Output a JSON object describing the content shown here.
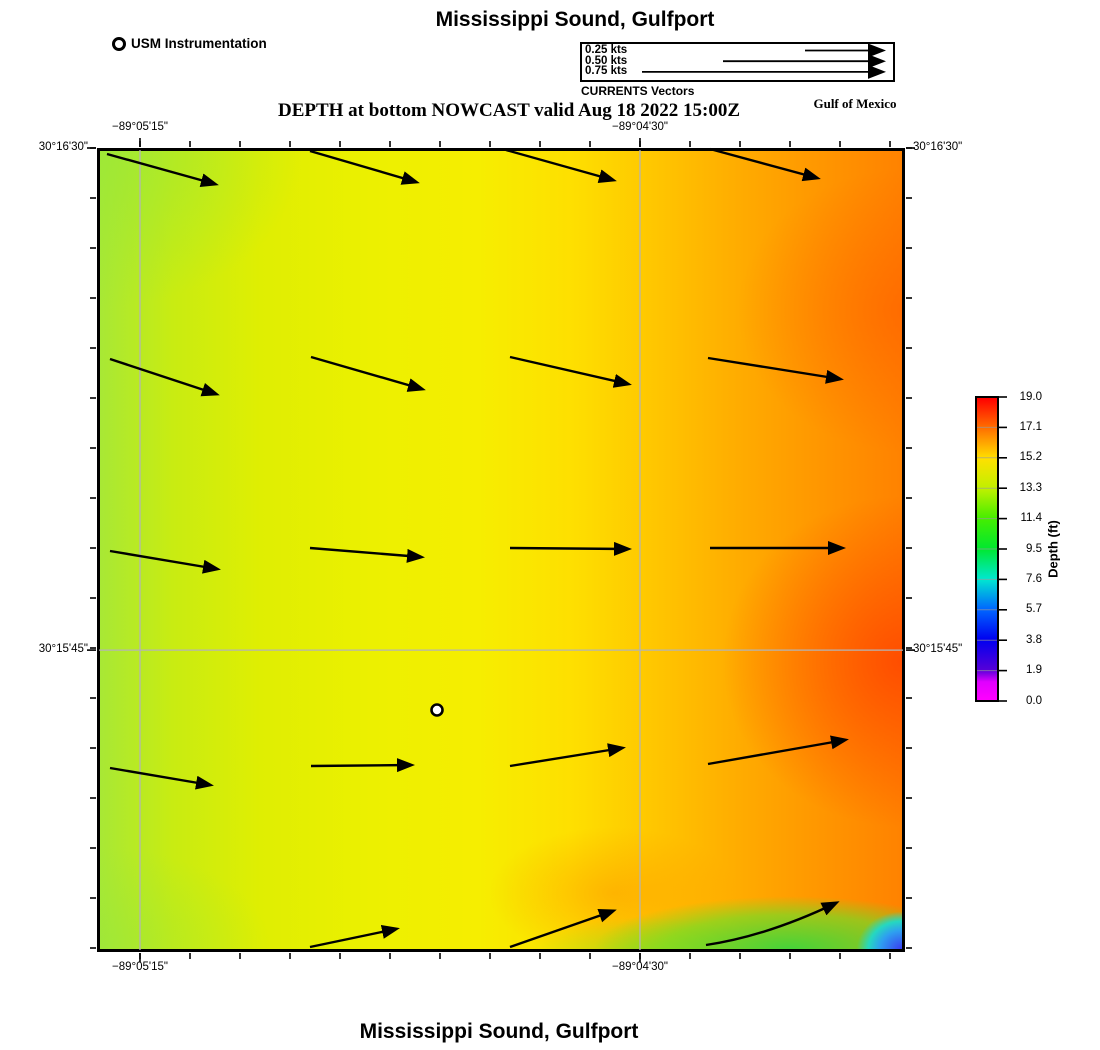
{
  "titles": {
    "top": "Mississippi Sound, Gulfport",
    "subtitle": "DEPTH at bottom NOWCAST valid Aug 18 2022 15:00Z",
    "region": "Gulf of Mexico",
    "bottom": "Mississippi Sound, Gulfport"
  },
  "legend": {
    "instrumentation_label": "USM Instrumentation",
    "vectors_caption": "CURRENTS Vectors",
    "speeds": [
      {
        "label": "0.25 kts",
        "tail_x": 805
      },
      {
        "label": "0.50 kts",
        "tail_x": 723
      },
      {
        "label": "0.75 kts",
        "tail_x": 642
      }
    ]
  },
  "chart_data": {
    "type": "heatmap",
    "title": "Mississippi Sound, Gulfport",
    "subtitle": "DEPTH at bottom NOWCAST valid Aug 18 2022 15:00Z",
    "product": "DEPTH at bottom NOWCAST",
    "valid_time": "Aug 18 2022 15:00Z",
    "region": "Gulf of Mexico",
    "x_axis": {
      "labels": [
        "−89°05'15\"",
        "−89°04'30\""
      ],
      "fracs": [
        0.0532,
        0.672
      ]
    },
    "y_axis": {
      "labels": [
        "30°16'30\"",
        "30°15'45\""
      ],
      "fracs": [
        0.0,
        0.6245
      ]
    },
    "depth_pattern": {
      "west_ft": 14,
      "center_ft": 15.5,
      "east_ft": 18.5,
      "southeast_corner_ft": 4,
      "description": "depth increases west (yellow-green ~13-15 ft) to east (orange-red ~17-19 ft); shallow blue-cyan pocket ~2-8 ft in extreme southeast corner with green band along south edge"
    },
    "station": {
      "label": "USM Instrumentation",
      "x": 437,
      "y": 710
    },
    "arrows": [
      [
        107,
        154,
        215,
        184
      ],
      [
        310,
        151,
        416,
        182
      ],
      [
        506,
        150,
        613,
        180
      ],
      [
        710,
        149,
        817,
        178
      ],
      [
        110,
        359,
        216,
        394
      ],
      [
        311,
        357,
        422,
        389
      ],
      [
        510,
        357,
        628,
        384
      ],
      [
        708,
        358,
        840,
        379
      ],
      [
        110,
        551,
        217,
        569
      ],
      [
        310,
        548,
        421,
        557
      ],
      [
        510,
        548,
        628,
        549
      ],
      [
        710,
        548,
        842,
        548
      ],
      [
        110,
        768,
        210,
        785
      ],
      [
        311,
        766,
        411,
        765
      ],
      [
        510,
        766,
        622,
        748
      ],
      [
        708,
        764,
        845,
        740
      ],
      [
        310,
        947,
        396,
        929
      ],
      [
        510,
        947,
        613,
        911
      ],
      [
        706,
        945,
        767,
        936,
        836,
        903
      ]
    ],
    "colorbar": {
      "label": "Depth (ft)",
      "ticks": [
        "19.0",
        "17.1",
        "15.2",
        "13.3",
        "11.4",
        "9.5",
        "7.6",
        "5.7",
        "3.8",
        "1.9",
        "0.0"
      ],
      "palette": [
        {
          "c": "#ff0000",
          "p": 0
        },
        {
          "c": "#ff7000",
          "p": 10
        },
        {
          "c": "#ffe000",
          "p": 20
        },
        {
          "c": "#c0f000",
          "p": 30
        },
        {
          "c": "#44ee00",
          "p": 40
        },
        {
          "c": "#00e830",
          "p": 50
        },
        {
          "c": "#00e8d0",
          "p": 60
        },
        {
          "c": "#0066ff",
          "p": 70
        },
        {
          "c": "#0000f0",
          "p": 80
        },
        {
          "c": "#5500d8",
          "p": 90
        },
        {
          "c": "#e000ff",
          "p": 94
        },
        {
          "c": "#ff00ff",
          "p": 100
        }
      ]
    }
  }
}
